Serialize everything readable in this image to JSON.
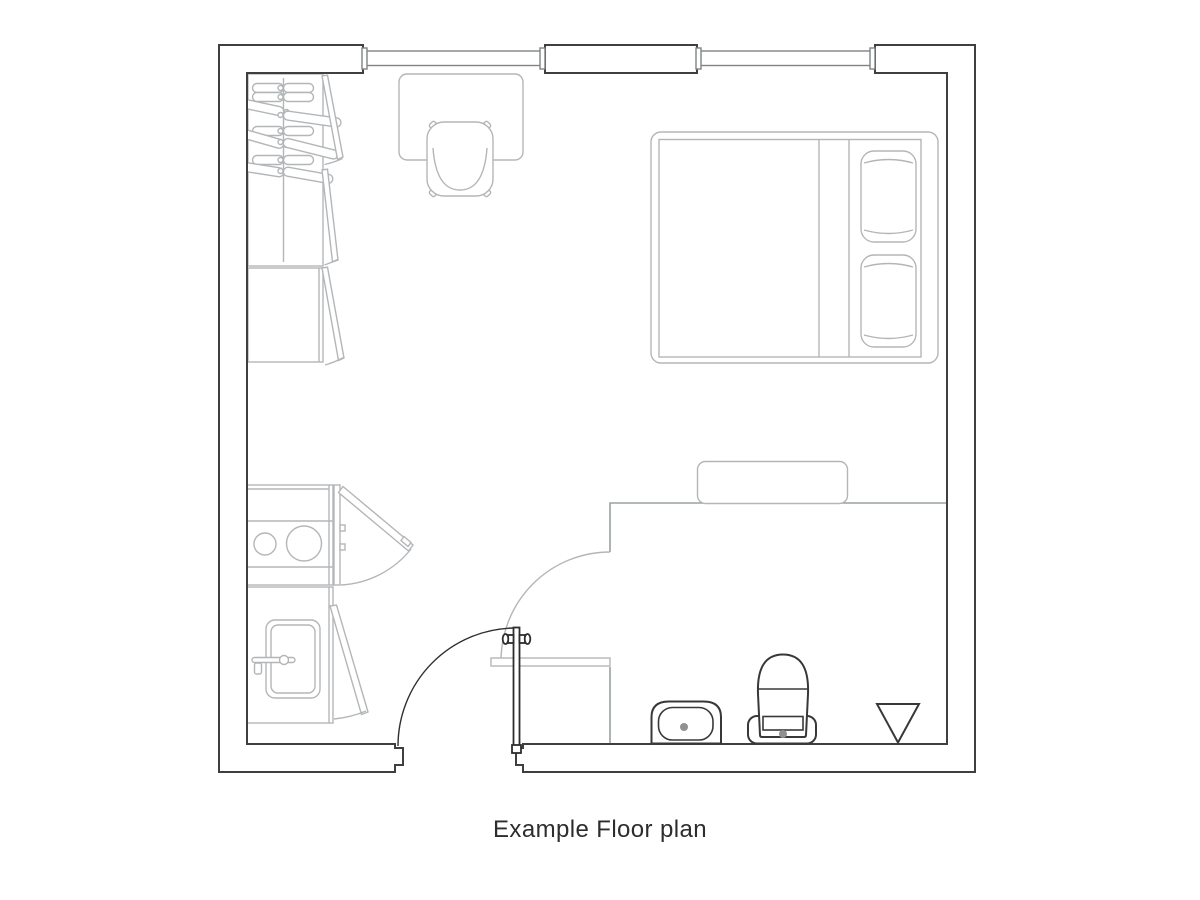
{
  "caption": "Example Floor plan",
  "colors": {
    "background": "#ffffff",
    "wall": "#3f3f3f",
    "window": "#7f8486",
    "partition": "#9aa0a2",
    "furniture": "#b3b6b8",
    "door": "#2e2e2e",
    "fixture": "#383838",
    "dot": "#8f9193",
    "caption_text": "#2d2d2d"
  },
  "wardrobe": {
    "rod_x": 283.5,
    "hangers": [
      {
        "side": "left",
        "y": 88,
        "rot": 0,
        "len": 31
      },
      {
        "side": "left",
        "y": 97,
        "rot": 0,
        "len": 31
      },
      {
        "side": "left",
        "y": 112,
        "rot": 12,
        "len": 62
      },
      {
        "side": "left",
        "y": 131,
        "rot": 0,
        "len": 31
      },
      {
        "side": "left",
        "y": 145,
        "rot": 16,
        "len": 60
      },
      {
        "side": "left",
        "y": 160,
        "rot": 0,
        "len": 31
      },
      {
        "side": "left",
        "y": 173,
        "rot": 9,
        "len": 56
      },
      {
        "side": "right",
        "y": 88,
        "rot": 0,
        "len": 30
      },
      {
        "side": "right",
        "y": 97,
        "rot": 0,
        "len": 30
      },
      {
        "side": "right",
        "y": 115,
        "rot": 8,
        "len": 58
      },
      {
        "side": "right",
        "y": 131,
        "rot": 0,
        "len": 30
      },
      {
        "side": "right",
        "y": 142,
        "rot": 14,
        "len": 56
      },
      {
        "side": "right",
        "y": 160,
        "rot": 0,
        "len": 30
      },
      {
        "side": "right",
        "y": 171,
        "rot": 10,
        "len": 50
      }
    ]
  }
}
